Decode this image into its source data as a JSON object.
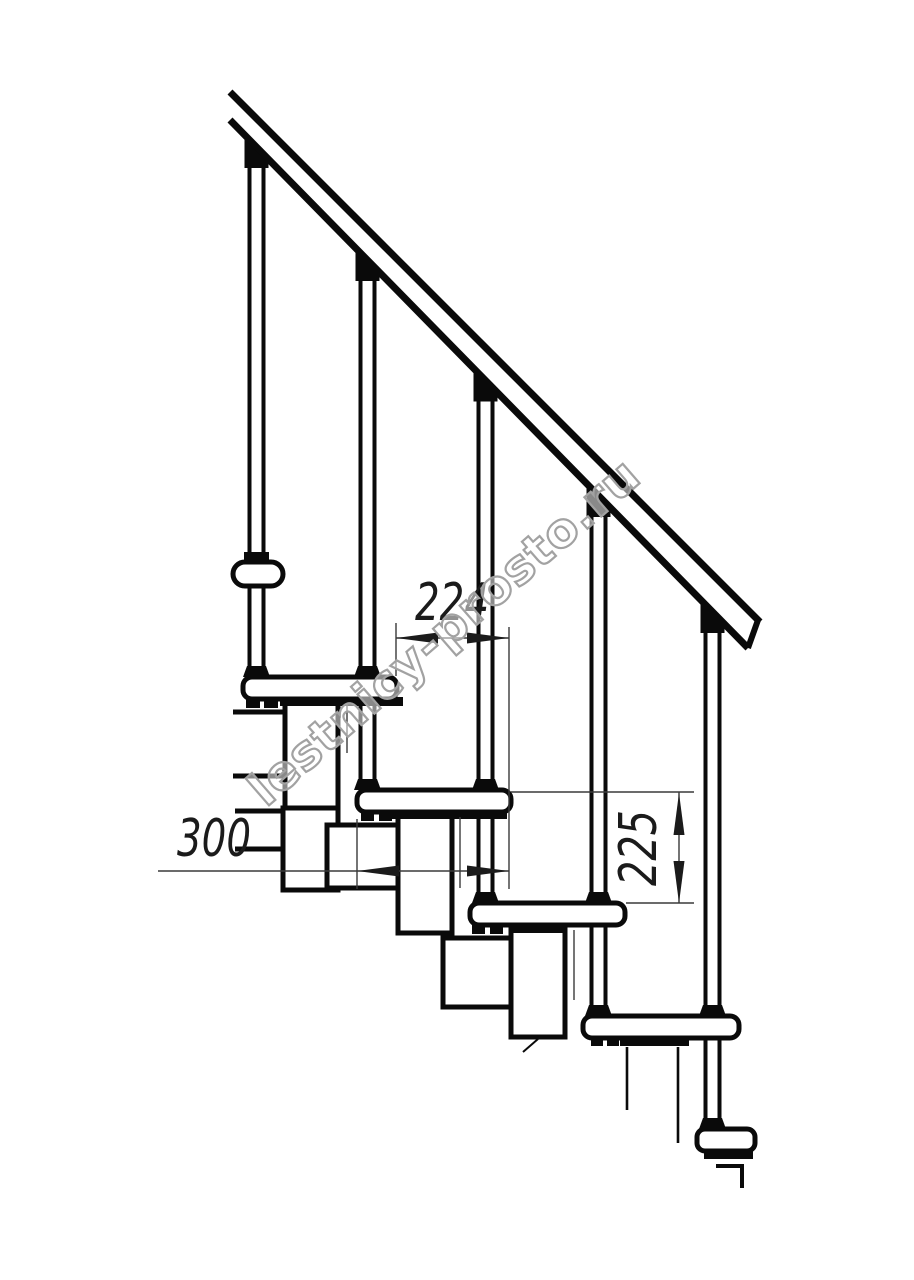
{
  "page": {
    "background": "#ffffff",
    "line_color": "#0a0a0a",
    "thin_line_color": "#3a3a3a",
    "watermark_color": "#a2a2a2"
  },
  "drawing": {
    "title": "modular staircase side elevation",
    "dimensions": {
      "going_label": "224",
      "tread_depth_label": "300",
      "riser_height_label": "225"
    },
    "watermark_text": "lestnicy-prosto.ru"
  }
}
